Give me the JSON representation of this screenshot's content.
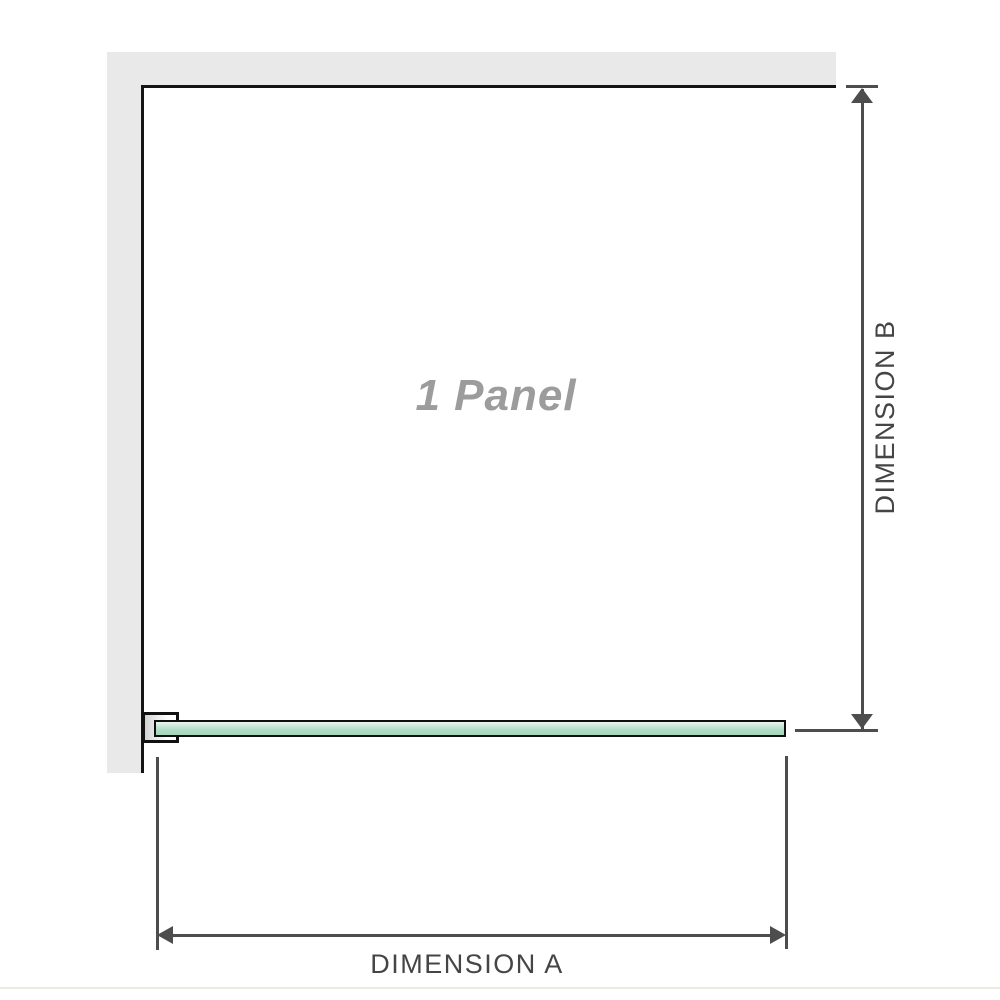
{
  "diagram": {
    "panel_label": "1 Panel",
    "dimensions": {
      "a_label": "DIMENSION A",
      "b_label": "DIMENSION B"
    }
  },
  "colors": {
    "wall_fill": "#e9e9e9",
    "wall_edge": "#141414",
    "glass_border": "#0f0f0f",
    "glass_gradient_top": "#e9f7ef",
    "glass_gradient_bottom": "#a4d6ba",
    "dimension_lines": "#4d4d4d",
    "dimension_text": "#454545",
    "panel_label_text": "#9c9c9c"
  }
}
